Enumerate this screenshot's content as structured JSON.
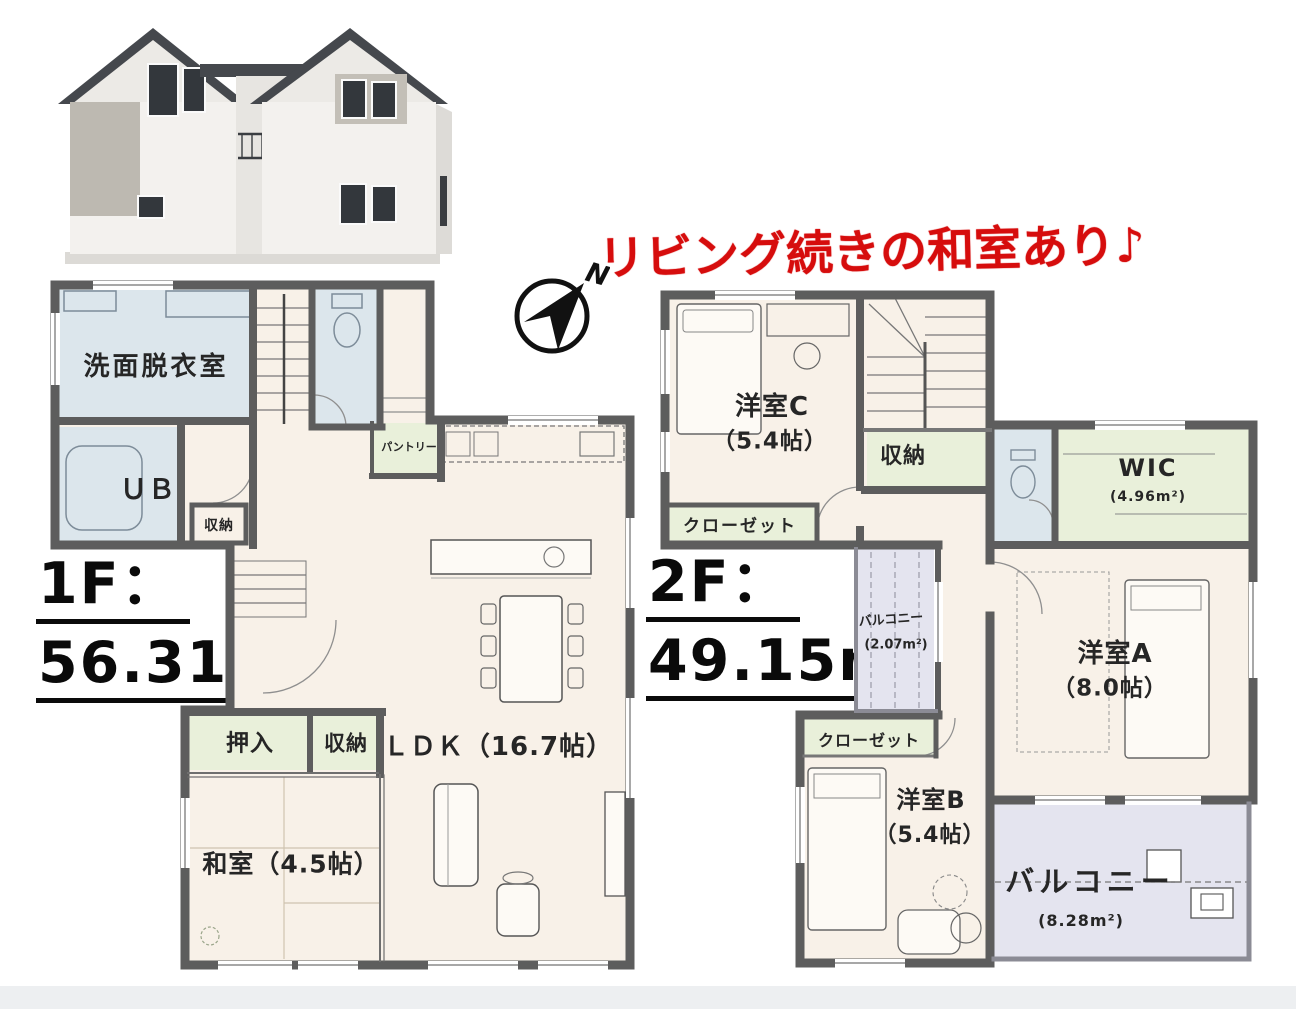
{
  "banner": {
    "text": "リビング続きの和室あり♪"
  },
  "compass": {
    "north_label": "N"
  },
  "colors": {
    "accent_red": "#d60d0d",
    "wall_gray": "#5d5d5d",
    "room_cream": "#f8f1e8",
    "wet_blue": "#dce6ec",
    "storage_green": "#e9f0da",
    "balcony_lavender": "#e4e4ef"
  },
  "floors": {
    "f1": {
      "title": "1F：",
      "area": "56.31m",
      "area_exponent": "2",
      "rooms": {
        "washroom": "洗面脱衣室",
        "unit_bath": "ＵＢ",
        "hall_storage": "収納",
        "pantry": "パントリー",
        "ldk": "ＬＤＫ（16.7帖）",
        "oshiire": "押入",
        "storage": "収納",
        "washitsu": "和室（4.5帖）"
      }
    },
    "f2": {
      "title": "2F：",
      "area": "49.15m",
      "area_exponent": "2",
      "rooms": {
        "bedroom_c": "洋室C",
        "bedroom_c_size": "（5.4帖）",
        "closet_c": "クローゼット",
        "storage": "収納",
        "wic": "WIC",
        "wic_size": "(4.96m²)",
        "balcony_small": "バルコニー",
        "balcony_small_size": "(2.07m²)",
        "bedroom_a": "洋室A",
        "bedroom_a_size": "（8.0帖）",
        "closet_b": "クローゼット",
        "bedroom_b": "洋室B",
        "bedroom_b_size": "（5.4帖）",
        "balcony_large": "バルコニー",
        "balcony_large_size": "(8.28m²)"
      }
    }
  }
}
